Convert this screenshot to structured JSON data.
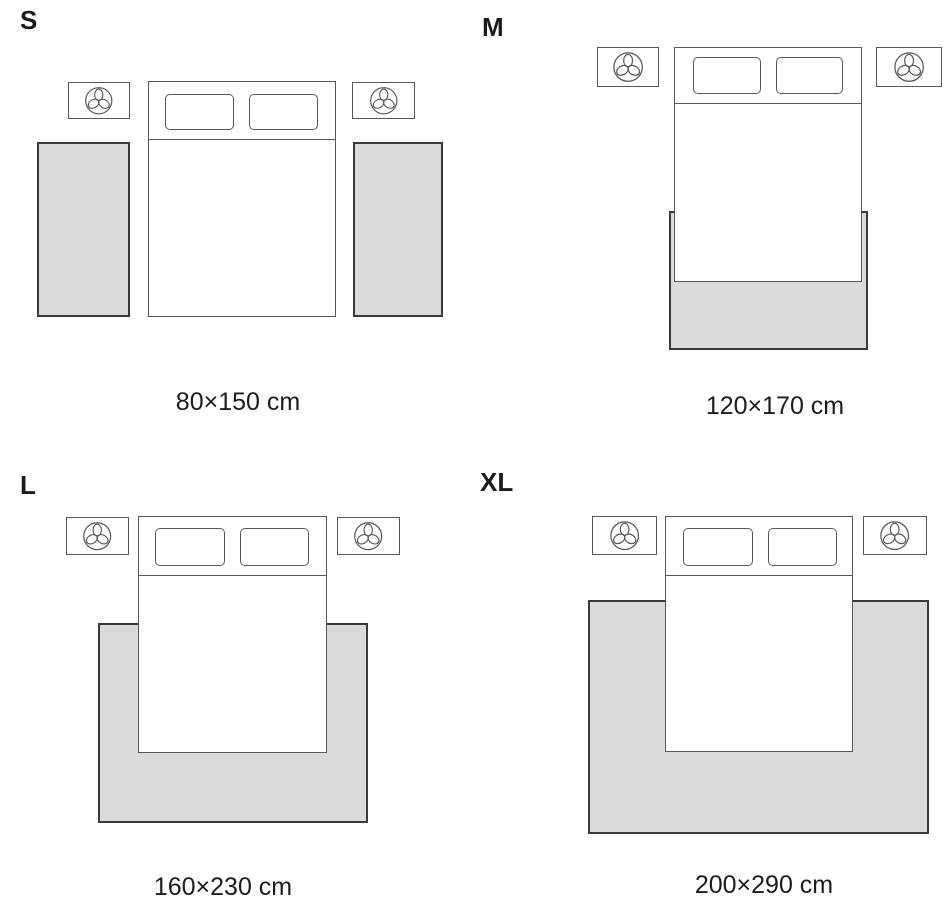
{
  "guide": {
    "type": "rug-size-guide-bedroom",
    "variants": [
      {
        "label": "S",
        "dimensions": "80×150 cm",
        "rug_layout": "two-runner-rugs-beside-bed"
      },
      {
        "label": "M",
        "dimensions": "120×170 cm",
        "rug_layout": "rug-under-foot-of-bed"
      },
      {
        "label": "L",
        "dimensions": "160×230 cm",
        "rug_layout": "rug-under-lower-two-thirds-of-bed"
      },
      {
        "label": "XL",
        "dimensions": "200×290 cm",
        "rug_layout": "large-rug-under-bed-full-width"
      }
    ]
  },
  "icons": {
    "nightstand_decor": "plant-icon"
  },
  "colors": {
    "rug-fill": "#dadada",
    "rug-border": "#3a3a3a",
    "furniture-border": "#575757",
    "text": "#1c1c1c",
    "background": "#ffffff"
  }
}
